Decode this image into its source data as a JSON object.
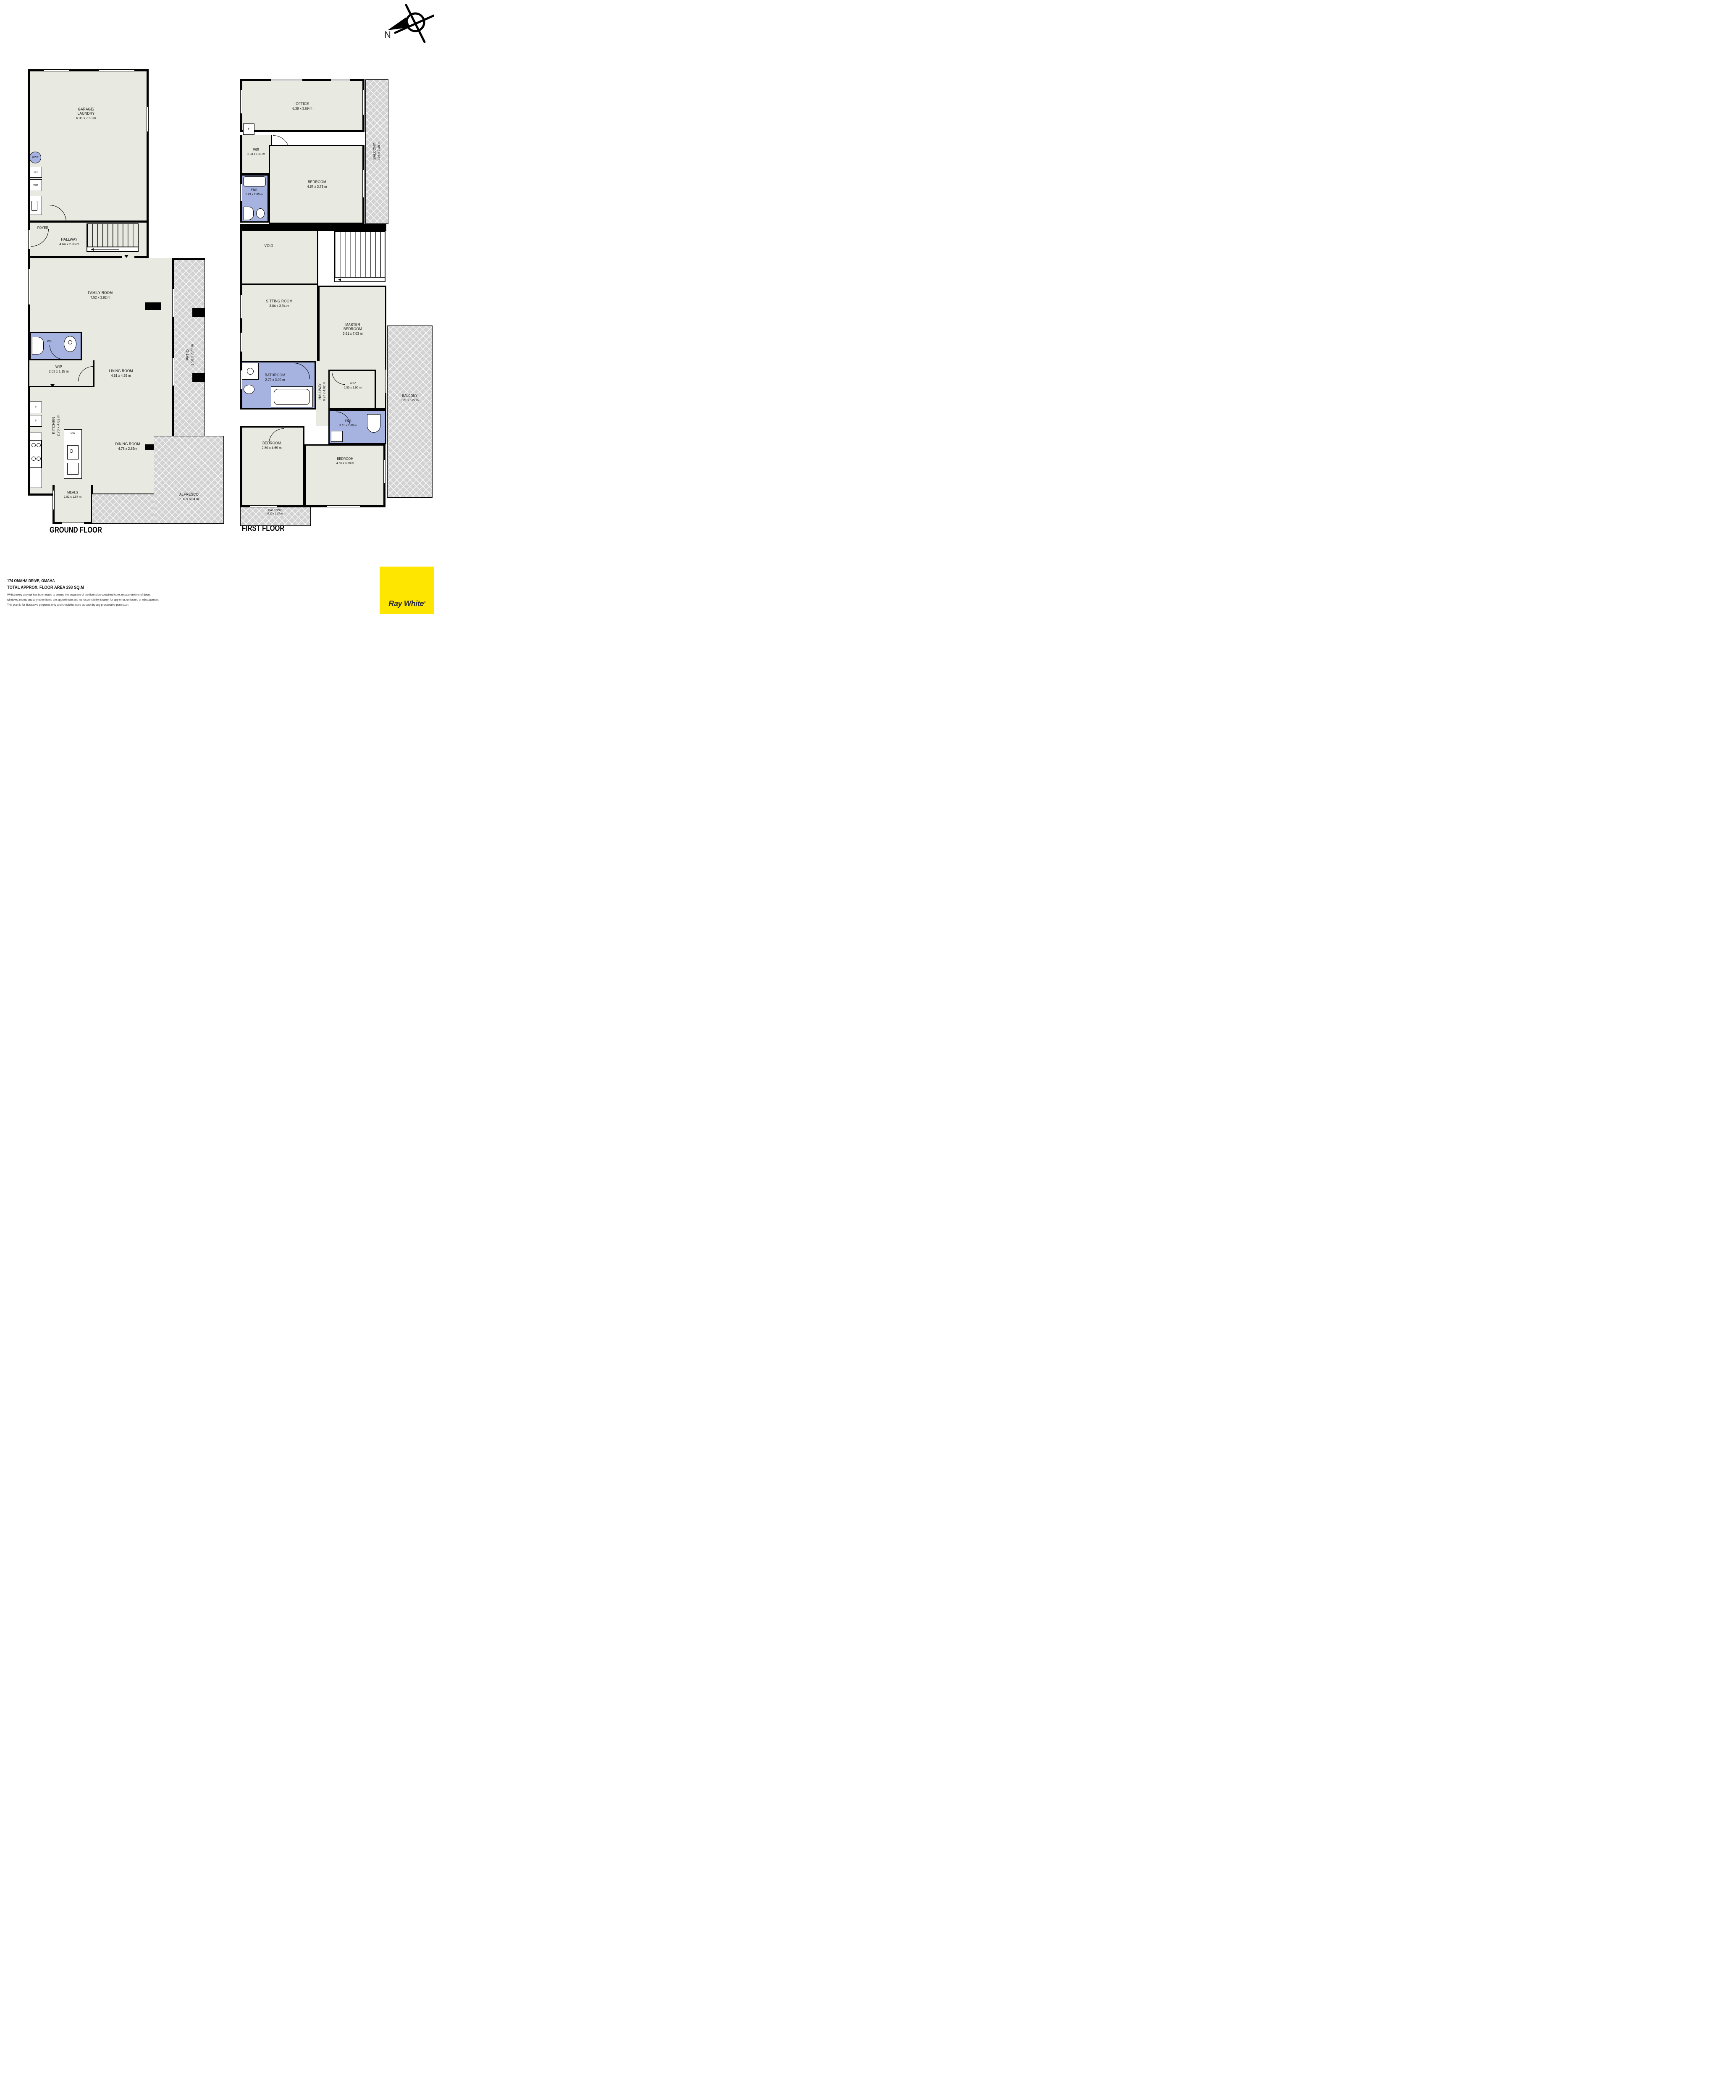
{
  "page": {
    "compass_n": "N",
    "ground_floor_label": "GROUND FLOOR",
    "first_floor_label": "FIRST FLOOR"
  },
  "ground": {
    "garage": {
      "line1": "GARAGE/",
      "line2": "LAUNDRY",
      "dims": "6.05 x 7.50 m"
    },
    "hwt": "H.W.T",
    "dr": "DR",
    "wm": "WM",
    "foyer": "FOYER",
    "hallway": {
      "name": "HALLWAY",
      "dims": "4.64 x 2.36 m"
    },
    "family": {
      "name": "FAMILY ROOM",
      "dims": "7.52 x 3.82 m"
    },
    "wc": "WC",
    "wip": {
      "name": "WIP",
      "dims": "2.63 x 1.15 m"
    },
    "living": {
      "name": "LIVING ROOM",
      "dims": "4.81 x 4.39 m"
    },
    "kitchen": {
      "name": "KITCHEN",
      "dims": "2.73 x 4.82 m"
    },
    "fridge1": "F",
    "fridge2": "F",
    "dw": "DW",
    "dining": {
      "name": "DINING ROOM",
      "dims": "4.78 x 2.83m"
    },
    "meals": {
      "name": "MEALS",
      "dims": "1.82 x 1.57 m"
    },
    "patio": {
      "name": "PATIO",
      "dims": "1.56 x 7.77 m"
    },
    "alfresco": {
      "name": "ALFRESCO",
      "dims": "7.02 x 6.04 m"
    }
  },
  "first": {
    "office": {
      "name": "OFFICE",
      "dims": "6.38 x 3.69 m"
    },
    "f": "F",
    "wir": {
      "name": "WIR",
      "dims": "2.04 x 1.81 m"
    },
    "ens_upper": {
      "name": "ENS",
      "dims": "1.43 x 2.85 m"
    },
    "bedroom2": {
      "name": "BEDROOM",
      "dims": "4.87 x 3.73 m"
    },
    "balcony_east": {
      "name": "BALCONY",
      "dims": "1.06 x 7.48 m"
    },
    "void": "VOID",
    "sitting": {
      "name": "SITTING ROOM",
      "dims": "3.84 x 3.94 m"
    },
    "master": {
      "line1": "MASTER",
      "line2": "BEDROOM",
      "dims": "3.61 x 7.03 m"
    },
    "bathroom": {
      "name": "BATHROOM",
      "dims": "2.79 x 3.00 m"
    },
    "hallway": {
      "name": "HALLWAY",
      "dims": "0.97 x 4.02 m"
    },
    "wir2": {
      "name": "WIR",
      "dims": "1.53 x 1.90 m"
    },
    "ens_lower": {
      "name": "ENS",
      "dims": "3.61 x 1.60 m"
    },
    "balcony_right": {
      "name": "BALCONY",
      "dims": "1.81 x 8.22 m"
    },
    "bedroom3": {
      "name": "BEDROOM",
      "dims": "2.80 x 4.69 m"
    },
    "bedroom4": {
      "name": "BEDROOM",
      "dims": "4.65 x 3.68 m"
    },
    "balcony_south": {
      "name": "BALCONY",
      "dims": "5.20 x 1.37 m"
    }
  },
  "footer": {
    "address": "174 OMAHA DRIVE, OMAHA",
    "area": "TOTAL APPROX. FLOOR AREA 293 SQ.M",
    "disclaimer_line1": "Whilst every attempt has been made to ensure the accuracy of the floor plan contained here, measurements of doors,",
    "disclaimer_line2": "windows, rooms and any other items are approximate and no responsibility is taken for any error, omission, or misstatement.",
    "disclaimer_line3": "This plan is for illustrative purposes only and should be used as such by any prospective purchaser."
  },
  "logo": {
    "brand": "Ray White",
    "reg": "®"
  },
  "colors": {
    "room_fill": "#e8e9e0",
    "wet_fill": "#a6b2e0",
    "paving_fill": "#d2d2d2",
    "wall": "#000000",
    "brand_yellow": "#ffe600",
    "brand_text": "#2e2e36"
  }
}
